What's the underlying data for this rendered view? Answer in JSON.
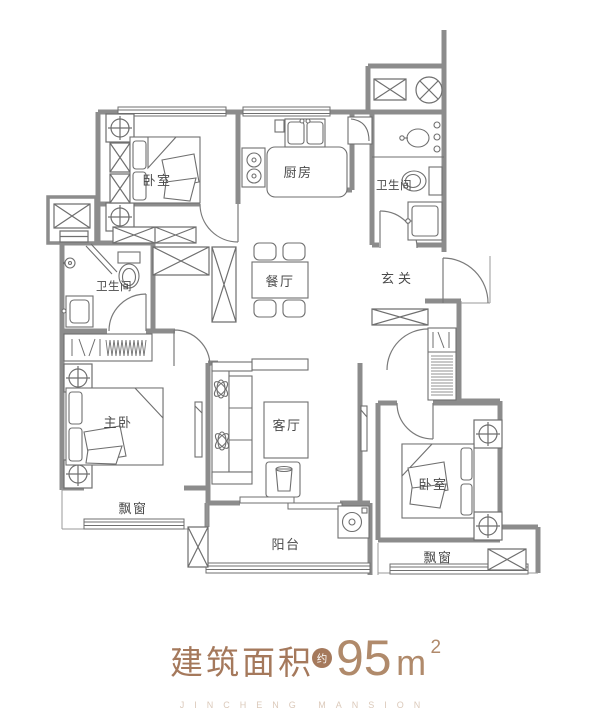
{
  "plan": {
    "rooms": {
      "bedroom_top": {
        "label": "卧室"
      },
      "kitchen": {
        "label": "厨房"
      },
      "bath_top": {
        "label": "卫生间"
      },
      "entry": {
        "label": "玄关"
      },
      "dining": {
        "label": "餐厅"
      },
      "bath_left": {
        "label": "卫生间"
      },
      "master_bedroom": {
        "label": "主卧"
      },
      "living": {
        "label": "客厅"
      },
      "balcony": {
        "label": "阳台"
      },
      "bedroom_right": {
        "label": "卧室"
      },
      "bay_window_left": {
        "label": "飘窗"
      },
      "bay_window_right": {
        "label": "飘窗"
      }
    },
    "icons": {
      "column_marker_icon": "square-circle-cross",
      "exhaust_fan_icon": "circle-with-x",
      "shaft_icon": "box-with-x",
      "door_swing_icon": "quarter-arc",
      "window_icon": "triple-parallel-lines",
      "hanger_rack_icon": "zigzag-coil",
      "washing_machine_icon": "circle-in-square",
      "stove_icon": "two-burner-circles",
      "sink_icon": "basin-with-faucet",
      "toilet_icon": "tank-and-bowl",
      "shower_icon": "head-circle-with-arm"
    }
  },
  "footer": {
    "area_label": "建筑面积",
    "approx_badge": "约",
    "area_value": "95",
    "area_unit": "m",
    "area_superscript": "2",
    "watermark": "JINCHENG MANSION"
  },
  "colors": {
    "accent": "#a5795c",
    "value_text": "#b08a6b",
    "watermark": "#dbc9ba",
    "wall": "#8c8c8c",
    "line": "#6f6f6f",
    "label": "#4a4a4a",
    "badge_bg": "#a5795c",
    "badge_text": "#ffffff"
  }
}
